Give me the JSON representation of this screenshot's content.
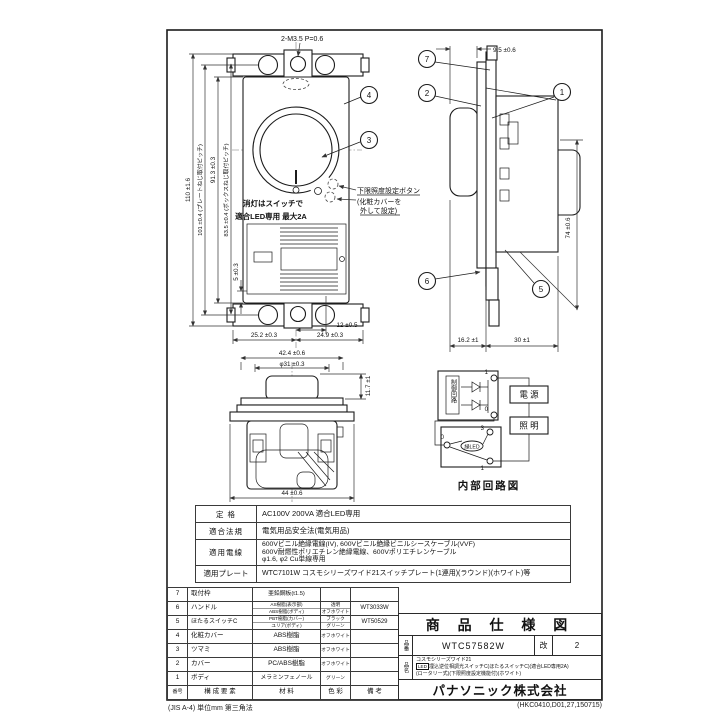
{
  "frame": {
    "footer_left": "(JIS A-4) 単位mm 第三角法",
    "footer_right": "(HKC0410,D01,27,150715)"
  },
  "front_view": {
    "screw_note": "2-M3.5 P=0.6",
    "dim_110": "110 ±1.6",
    "dim_101": "101 ±0.4 (プレートねじ取付ピッチ)",
    "dim_913": "91.3 ±0.3",
    "dim_835": "83.5 ±0.4 (ボックスねじ取付ピッチ)",
    "dim_5": "5 ±0.3",
    "dim_12": "12 ±0.5",
    "dim_252": "25.2 ±0.3",
    "dim_249": "24.9 ±0.3",
    "label_off": "消灯はスイッチで",
    "label_led": "適合LED専用 最大2A",
    "note_1": "下限照度設定ボタン",
    "note_2": "(化粧カバーを",
    "note_3": "外して設定)",
    "callout_3": "3",
    "callout_4": "4"
  },
  "side_view": {
    "dim_95": "9.5 ±0.6",
    "dim_74": "74 ±0.6",
    "dim_162": "16.2 ±1",
    "dim_30": "30 ±1",
    "callout_1": "1",
    "callout_2": "2",
    "callout_5": "5",
    "callout_6": "6",
    "callout_7": "7"
  },
  "bottom_view": {
    "dim_424": "42.4 ±0.6",
    "dim_phi31": "φ31 ±0.3",
    "dim_117": "11.7 ±1",
    "dim_44": "44 ±0.6"
  },
  "circuit": {
    "control": "制御回路",
    "power": "電 源",
    "light": "照 明",
    "led": "緑LED",
    "t_top_1": "1",
    "t_top_0": "0",
    "t_low_3": "3",
    "t_low_1": "1",
    "t_low_0": "0",
    "caption": "内部回路図"
  },
  "spec_table": {
    "rows": [
      {
        "label": "定 格",
        "value": "AC100V 200VA 適合LED専用"
      },
      {
        "label": "適合法規",
        "value": "電気用品安全法(電気用品)"
      },
      {
        "label": "適用電線",
        "lines": [
          "600Vビニル絶縁電線(IV), 600Vビニル絶縁ビニルシースケーブル(VVF)",
          "600V耐燃性ポリエチレン絶縁電線、600Vポリエチレンケーブル",
          "φ1.6, φ2 Cu単線専用"
        ]
      },
      {
        "label": "適用プレート",
        "value": "WTC7101W コスモシリーズワイド21スイッチプレート(1連用)(ラウンド)(ホワイト)等"
      }
    ]
  },
  "parts_table": {
    "header": {
      "num": "番号",
      "name": "構 成 要 素",
      "material": "材 料",
      "color": "色 彩",
      "remark": "備 考"
    },
    "rows": [
      {
        "num": "7",
        "name": "取付枠",
        "material": "亜鉛鋼板(t1.5)",
        "color": "",
        "remark": ""
      },
      {
        "num": "6",
        "name": "ハンドル",
        "material_1": "AS樹脂(表示部)",
        "material_2": "ABS樹脂(ボディ)",
        "color_1": "透明",
        "color_2": "オフホワイト",
        "remark": "WT3033W"
      },
      {
        "num": "5",
        "name": "ほたるスイッチC",
        "material_1": "PBT樹脂(カバー)",
        "material_2": "ユリア(ボディ)",
        "color_1": "ブラック",
        "color_2": "グリーン",
        "remark": "WT50529"
      },
      {
        "num": "4",
        "name": "化粧カバー",
        "material": "ABS樹脂",
        "color": "オフホワイト",
        "remark": ""
      },
      {
        "num": "3",
        "name": "ツマミ",
        "material": "ABS樹脂",
        "color": "オフホワイト",
        "remark": ""
      },
      {
        "num": "2",
        "name": "カバー",
        "material": "PC/ABS樹脂",
        "color": "オフホワイト",
        "remark": ""
      },
      {
        "num": "1",
        "name": "ボディ",
        "material": "メラミンフェノール",
        "color": "グリーン",
        "remark": ""
      }
    ]
  },
  "title_block": {
    "title": "商 品 仕 様 図",
    "part_no_label": "品番",
    "part_no": "WTC57582W",
    "rev_label": "改",
    "rev": "2",
    "name_label": "品名",
    "name_1": "コスモシリーズワイド21",
    "name_2_tag": "LED",
    "name_2": "埋込逆位相調光スイッチC(ほたるスイッチC)(適合LED専用2A)",
    "name_3": "(ロータリー式)(下限照度設定機能付)(ホワイト)",
    "company": "パナソニック株式会社"
  }
}
